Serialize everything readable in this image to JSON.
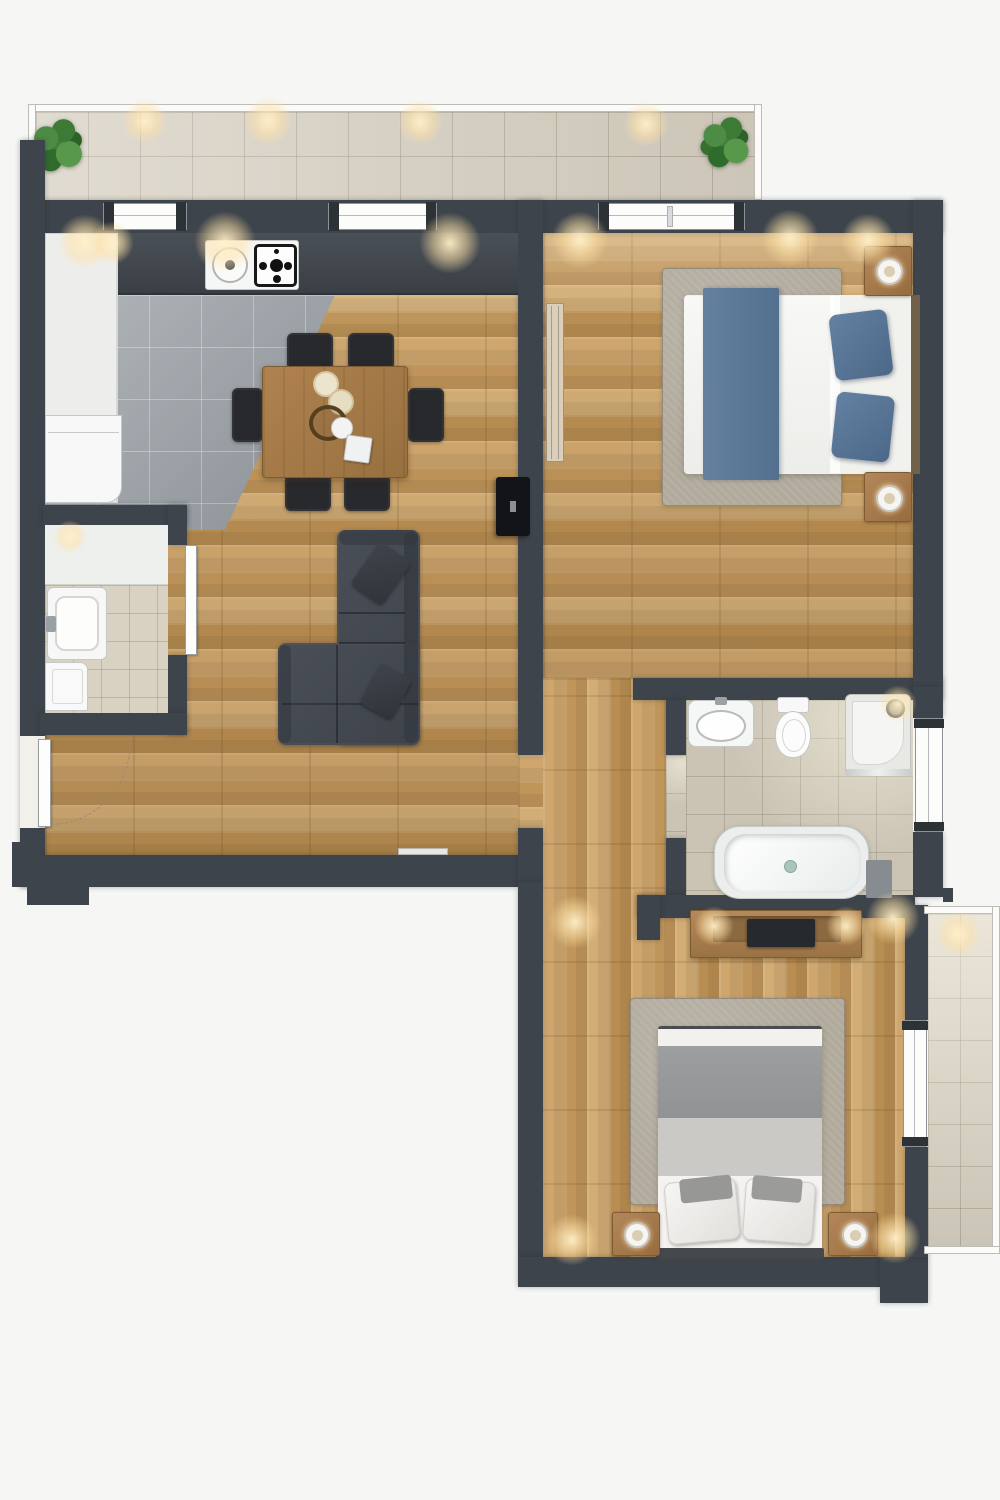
{
  "meta": {
    "kind": "architectural floor plan, top-down 3d render",
    "visible_text": "none",
    "canvas": {
      "width": 1000,
      "height": 1500
    }
  },
  "palette": {
    "background": "#f6f6f5",
    "wall": "#3e444b",
    "wood": "#c49a5f",
    "tileKitchen": "#9ba1a7",
    "tileBalcony": "#d7d0c2",
    "tileBath": "#cbc4b4",
    "tileWc": "#d9d2c2",
    "rug": "#b6afa2",
    "sofaGray": "#42474e",
    "bedBlue": "#587497",
    "blanketGray": "#96989a",
    "furnitureWood": "#a87c4e",
    "chairBlack": "#26282d",
    "fixtureWhite": "#f5f6f5",
    "railWhite": "#fbfbfa",
    "plantGreen": "#417f3a",
    "lightGlow": "#ffe3ae"
  },
  "rooms": [
    {
      "id": "balcony-top",
      "contents": [
        "floor tiles",
        "railing",
        "potted plant left",
        "potted plant right",
        "recessed lights"
      ]
    },
    {
      "id": "kitchen-dining-living",
      "contents": [
        "white cabinet column",
        "fridge",
        "dark counter with sink dial and gas hob",
        "gray tile kitchen floor",
        "dining table with 6 black chairs",
        "candles",
        "bowl",
        "cup",
        "sectional sofa with 2 pillows",
        "wall tv",
        "entry door with swing arc",
        "windows to balcony"
      ]
    },
    {
      "id": "shower-room",
      "contents": [
        "white counter",
        "shower tray with faucet",
        "washing machine",
        "beige tile floor",
        "open door"
      ]
    },
    {
      "id": "bedroom-1",
      "contents": [
        "double bed white duvet",
        "blue runner",
        "2 blue pillows",
        "gray rug",
        "2 nightstands with lamps",
        "tall wardrobe",
        "window to balcony"
      ]
    },
    {
      "id": "hallway",
      "contents": [
        "wood floor",
        "openings to living room, bedroom 1, bathroom, bedroom 2"
      ]
    },
    {
      "id": "bathroom",
      "contents": [
        "washbasin",
        "toilet",
        "corner shower",
        "bathtub",
        "bath mat",
        "beige tile floor",
        "frosted window"
      ]
    },
    {
      "id": "bedroom-2",
      "contents": [
        "media console with tv",
        "double bed gray blanket",
        "2 white pillows",
        "gray rug",
        "2 nightstands with lamps",
        "door to side balcony"
      ]
    },
    {
      "id": "balcony-side",
      "contents": [
        "floor tiles",
        "railing",
        "recessed light"
      ]
    }
  ]
}
